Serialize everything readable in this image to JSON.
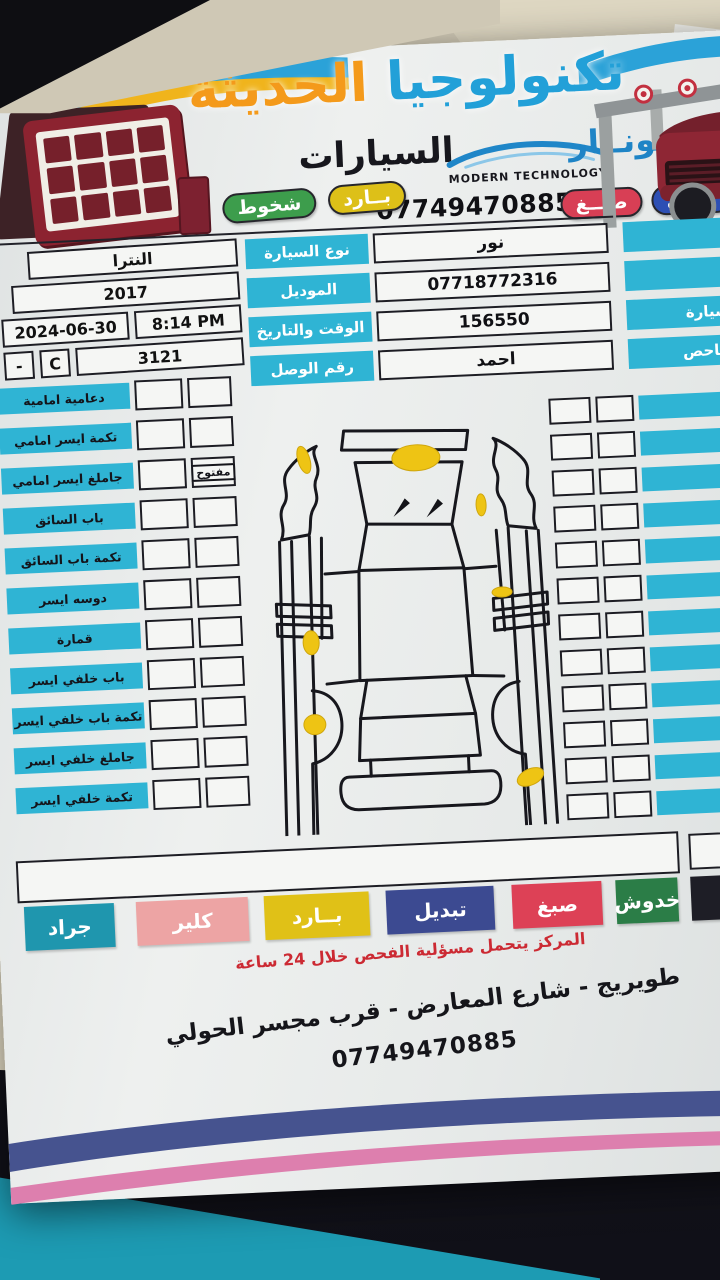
{
  "header": {
    "title_word1": "تكنولوجيا",
    "title_word2": "الحديثة",
    "subtitle": "السيارات",
    "brand_en": "MODERN TECHNOLOGY",
    "sonar_label": "لسونــار",
    "phone": "07749470885",
    "badges_row1": [
      {
        "label": "شخوط",
        "color": "#3d9d4c"
      },
      {
        "label": "بــارد",
        "color": "#ddc018"
      }
    ],
    "badges_row2": [
      {
        "label": "صبــغ",
        "color": "#d83f55"
      },
      {
        "label": "تبديل",
        "color": "#2d4fb4"
      }
    ]
  },
  "info": {
    "right_rows": [
      {
        "label": "الاسم",
        "value": "نور"
      },
      {
        "label": "الهاتف",
        "value": "07718772316"
      },
      {
        "label": "رقم السيارة",
        "value": "156550"
      },
      {
        "label": "اسم الفاحص",
        "value": "احمد"
      }
    ],
    "mid_labels": [
      "نوع السيارة",
      "الموديل",
      "الوقت والتاريخ",
      "رقم الوصل"
    ],
    "car_type": "النترا",
    "model": "2017",
    "date": "2024-06-30",
    "time": "8:14 PM",
    "receipt_dash": "-",
    "receipt_letter": "C",
    "receipt_no": "3121"
  },
  "checklist": {
    "left_rows": [
      {
        "label": "دعامية امامية",
        "tag": ""
      },
      {
        "label": "تكمة ايسر امامي",
        "tag": ""
      },
      {
        "label": "جاملغ ايسر امامي",
        "tag": "مفتوح"
      },
      {
        "label": "باب السائق",
        "tag": ""
      },
      {
        "label": "تكمة باب السائق",
        "tag": ""
      },
      {
        "label": "دوسه ايسر",
        "tag": ""
      },
      {
        "label": "قمارة",
        "tag": ""
      },
      {
        "label": "باب خلفي ايسر",
        "tag": ""
      },
      {
        "label": "تكمة باب خلفي ايسر",
        "tag": ""
      },
      {
        "label": "جاملغ خلفي ايسر",
        "tag": ""
      },
      {
        "label": "تكمة خلفي ايسر",
        "tag": ""
      }
    ],
    "right_rows": [
      {
        "label": "بنيد"
      },
      {
        "label": "ايمن امامي"
      },
      {
        "label": "ايمن امامي"
      },
      {
        "label": "الصدر"
      },
      {
        "label": "باب الصدر"
      },
      {
        "label": "سه ايمن"
      },
      {
        "label": "لف الصدر"
      },
      {
        "label": "خلفي ايمن"
      },
      {
        "label": "خلفي ايمن"
      },
      {
        "label": "لفي ايمن"
      },
      {
        "label": "نطة"
      },
      {
        "label": "خلفية"
      }
    ]
  },
  "notes_label": "ملاحظات",
  "legend": [
    {
      "label": "جراد",
      "color": "#1f96ae"
    },
    {
      "label": "كلير",
      "color": "#eda4a4"
    },
    {
      "label": "بــارد",
      "color": "#e0c117"
    },
    {
      "label": "تبديل",
      "color": "#3c4a91"
    },
    {
      "label": "صبغ",
      "color": "#dd4156"
    },
    {
      "label": "خدوش",
      "color": "#2b7d47"
    },
    {
      "label": "ضرب",
      "color": "#1e1e26"
    }
  ],
  "footer": {
    "warning": "المركز يتحمل مسؤلية الفحص خلال 24 ساعة",
    "address": "طويريج - شارع المعارض - قرب مجسر الحولي",
    "phone": "07749470885"
  }
}
